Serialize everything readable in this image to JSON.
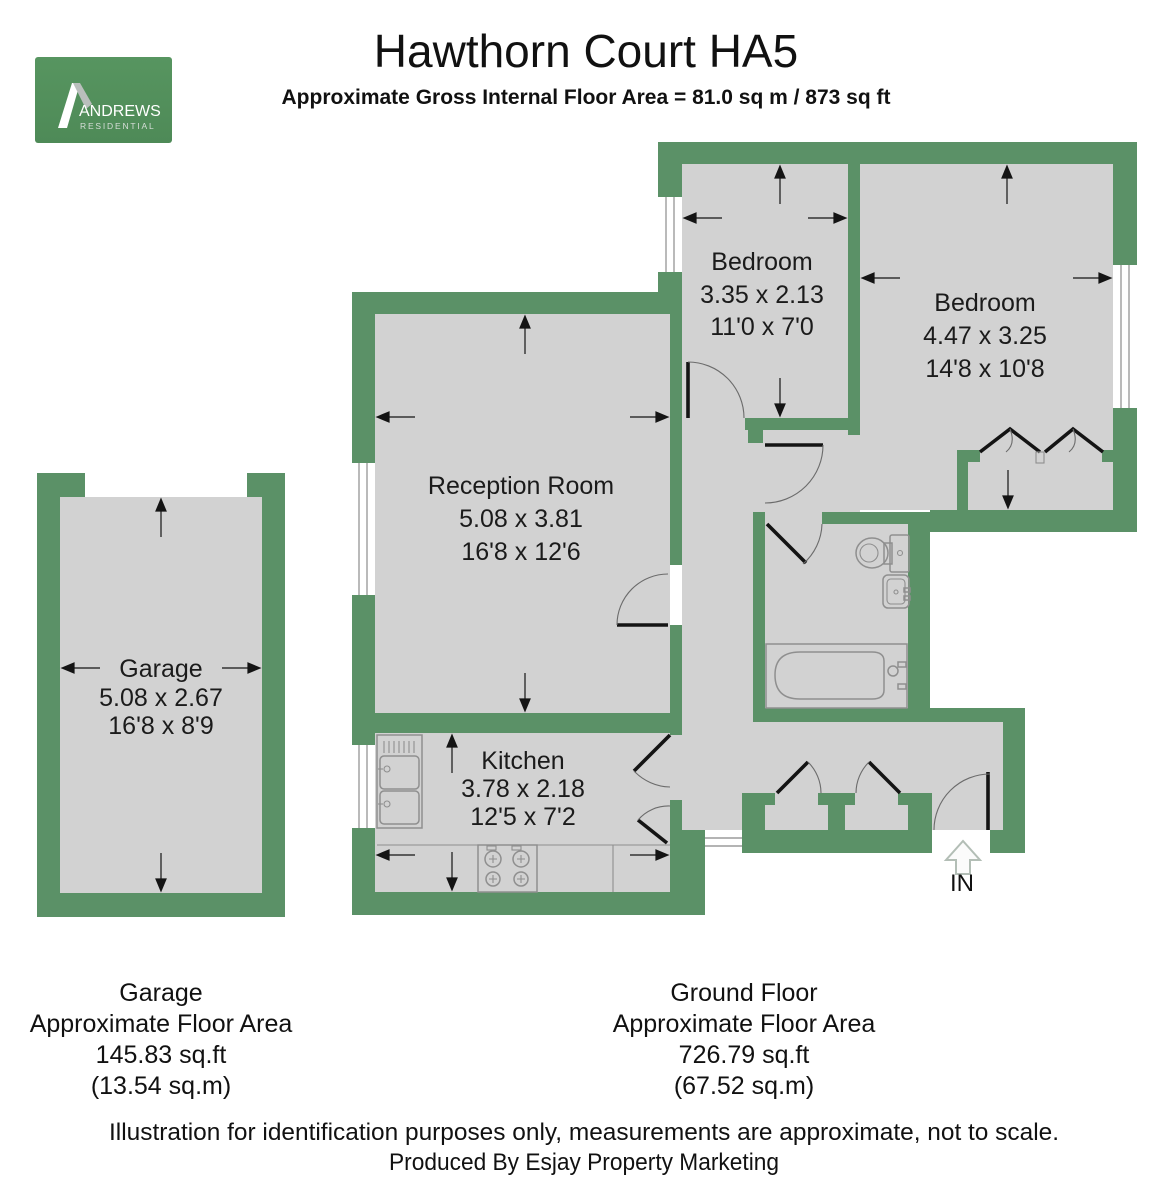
{
  "header": {
    "title": "Hawthorn Court HA5",
    "subtitle": "Approximate Gross Internal Floor Area = 81.0 sq m / 873 sq ft"
  },
  "logo": {
    "brand": "ANDREWS",
    "tagline": "RESIDENTIAL"
  },
  "colors": {
    "wall_green": "#5b9167",
    "floor_gray": "#d2d2d2",
    "logo_green": "#549058"
  },
  "rooms": {
    "reception": {
      "name": "Reception Room",
      "metric": "5.08 x 3.81",
      "imperial": "16'8 x 12'6"
    },
    "kitchen": {
      "name": "Kitchen",
      "metric": "3.78 x 2.18",
      "imperial": "12'5 x 7'2"
    },
    "bedroom1": {
      "name": "Bedroom",
      "metric": "3.35 x 2.13",
      "imperial": "11'0 x 7'0"
    },
    "bedroom2": {
      "name": "Bedroom",
      "metric": "4.47 x 3.25",
      "imperial": "14'8 x 10'8"
    },
    "garage": {
      "name": "Garage",
      "metric": "5.08 x 2.67",
      "imperial": "16'8 x 8'9"
    }
  },
  "entrance": {
    "label": "IN"
  },
  "captions": {
    "garage": {
      "line1": "Garage",
      "line2": "Approximate Floor Area",
      "line3": "145.83 sq.ft",
      "line4": "(13.54 sq.m)"
    },
    "ground_floor": {
      "line1": "Ground Floor",
      "line2": "Approximate Floor Area",
      "line3": "726.79 sq.ft",
      "line4": "(67.52 sq.m)"
    }
  },
  "footer": {
    "line1": "Illustration for identification purposes only, measurements are approximate, not to scale.",
    "line2": "Produced By Esjay Property Marketing"
  }
}
